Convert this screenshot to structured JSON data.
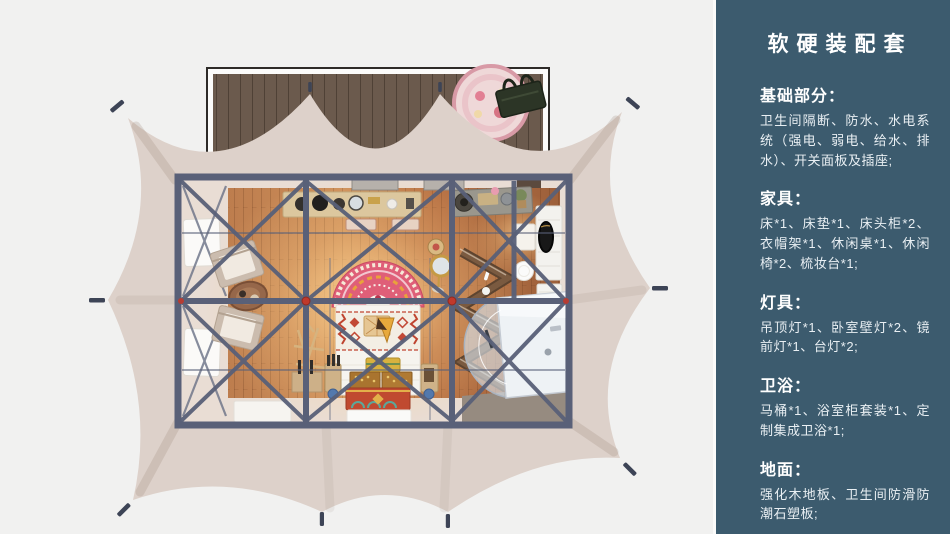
{
  "palette": {
    "page_bg": "#f1f1f0",
    "sidebar_bg": "#3c5b6e",
    "sidebar_text": "#e9eff3",
    "tent_canvas": "#ddd1ca",
    "tent_stake": "#3d4456",
    "deck_wood": "#6b5a4d",
    "deck_frame": "#2e2b28",
    "room_frame": "#596078",
    "room_wall": "#e9ddd4",
    "floor_glow": "#ffd796",
    "accent_red": "#c0392b",
    "bed_headboard": "#df5f78",
    "bed_linen": "#f6f4ef",
    "chest_red": "#c04a30",
    "chest_gold": "#d9b13f",
    "shelf_wood": "#7a5a40",
    "desk_wood": "#dcc79e",
    "shower_glass": "#eef2f5"
  },
  "illustration": {
    "description": "top-view 3d render of glamping tent floor plan with deck, bed, lounge and bathroom"
  },
  "sidebar": {
    "title": "软硬装配套",
    "sections": [
      {
        "heading": "基础部分：",
        "body": "卫生间隔断、防水、水电系统（强电、弱电、给水、排水）、开关面板及插座;"
      },
      {
        "heading": "家具：",
        "body": "床*1、床垫*1、床头柜*2、衣帽架*1、休闲桌*1、休闲椅*2、梳妆台*1;"
      },
      {
        "heading": "灯具：",
        "body": "吊顶灯*1、卧室壁灯*2、镜前灯*1、台灯*2;"
      },
      {
        "heading": "卫浴：",
        "body": "马桶*1、浴室柜套装*1、定制集成卫浴*1;"
      },
      {
        "heading": "地面：",
        "body": "强化木地板、卫生间防滑防潮石塑板;"
      }
    ]
  }
}
